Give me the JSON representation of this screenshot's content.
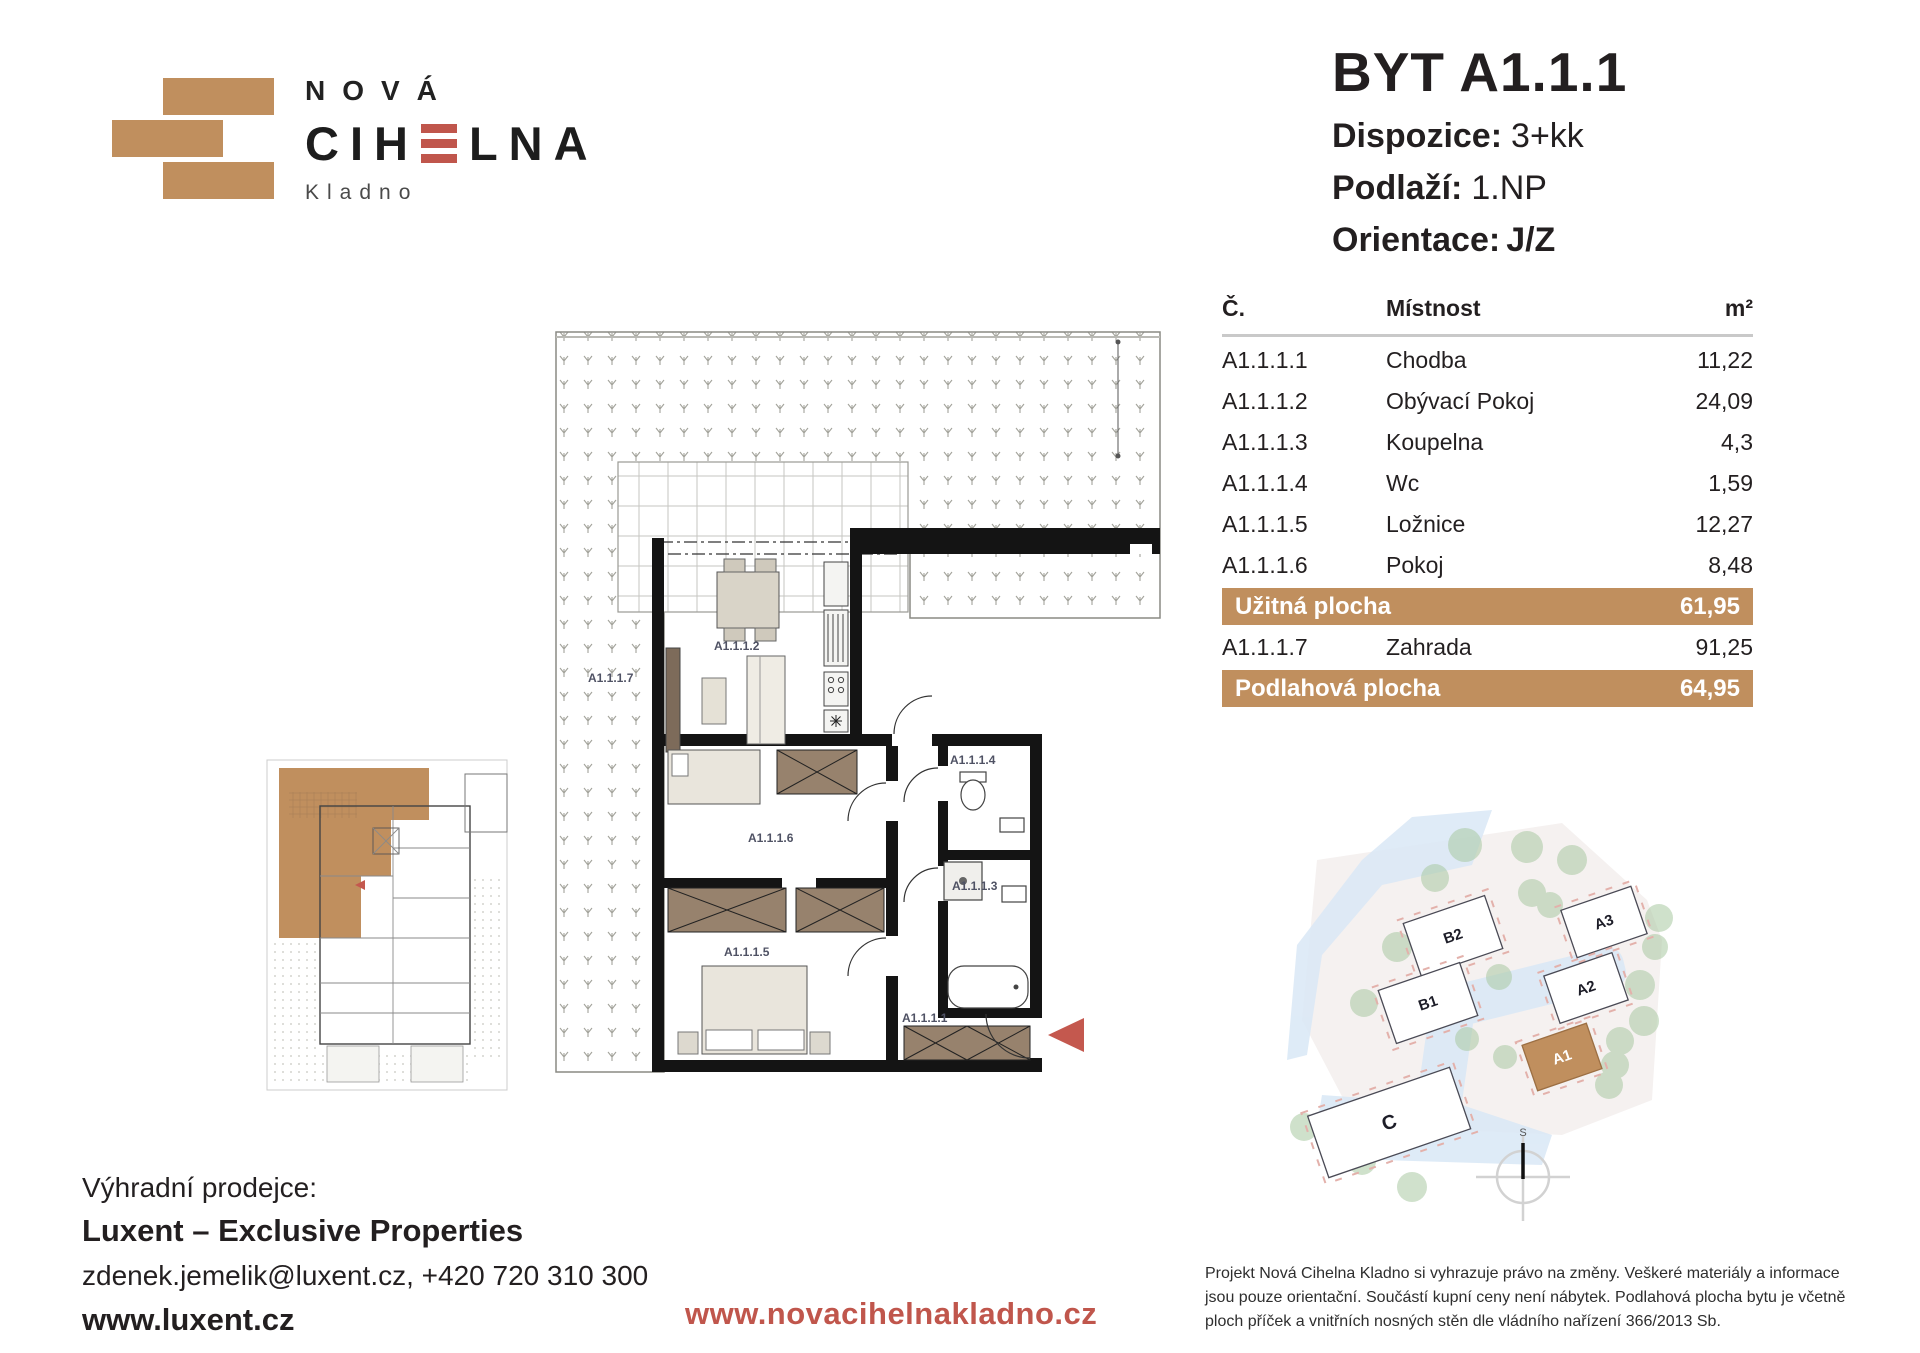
{
  "logo": {
    "line1": "NOVÁ",
    "brand_pre": "CIH",
    "brand_post": "LNA",
    "city": "Kladno"
  },
  "header": {
    "title": "BYT A1.1.1",
    "specs": {
      "dispozice_label": "Dispozice:",
      "dispozice_value": "3+kk",
      "podlazi_label": "Podlaží:",
      "podlazi_value": "1.NP",
      "orientace_label": "Orientace:",
      "orientace_value": "J/Z"
    }
  },
  "table": {
    "headers": {
      "code": "Č.",
      "room": "Místnost",
      "area": "m²"
    },
    "rows": [
      {
        "code": "A1.1.1.1",
        "room": "Chodba",
        "area": "11,22"
      },
      {
        "code": "A1.1.1.2",
        "room": "Obývací Pokoj",
        "area": "24,09"
      },
      {
        "code": "A1.1.1.3",
        "room": "Koupelna",
        "area": "4,3"
      },
      {
        "code": "A1.1.1.4",
        "room": "Wc",
        "area": "1,59"
      },
      {
        "code": "A1.1.1.5",
        "room": "Ložnice",
        "area": "12,27"
      },
      {
        "code": "A1.1.1.6",
        "room": "Pokoj",
        "area": "8,48"
      }
    ],
    "summary_usable": {
      "label": "Užitná plocha",
      "value": "61,95"
    },
    "extra_row": {
      "code": "A1.1.1.7",
      "room": "Zahrada",
      "area": "91,25"
    },
    "summary_floor": {
      "label": "Podlahová plocha",
      "value": "64,95"
    }
  },
  "floor_plan": {
    "terrace": "A1.1.1.7",
    "living": "A1.1.1.2",
    "room6": "A1.1.1.6",
    "wc": "A1.1.1.4",
    "bath": "A1.1.1.3",
    "bedroom": "A1.1.1.5",
    "hall": "A1.1.1.1"
  },
  "site_map": {
    "buildings": [
      "B2",
      "B1",
      "A3",
      "A2",
      "A1",
      "C"
    ],
    "highlighted": "A1",
    "compass": "S"
  },
  "footer": {
    "seller_label": "Výhradní prodejce:",
    "seller_name": "Luxent – Exclusive Properties",
    "contact": "zdenek.jemelik@luxent.cz, +420 720 310 300",
    "seller_web": "www.luxent.cz",
    "project_web": "www.novacihelnakladno.cz",
    "disclaimer": "Projekt Nová Cihelna Kladno si vyhrazuje právo na změny. Veškeré materiály a informace jsou pouze orientační. Součástí kupní ceny není nábytek. Podlahová plocha bytu je včetně ploch příček a vnitřních nosných stěn dle vládního nařízení 366/2013 Sb."
  },
  "colors": {
    "accent_brown": "#C08F5E",
    "accent_red": "#C0564C"
  }
}
